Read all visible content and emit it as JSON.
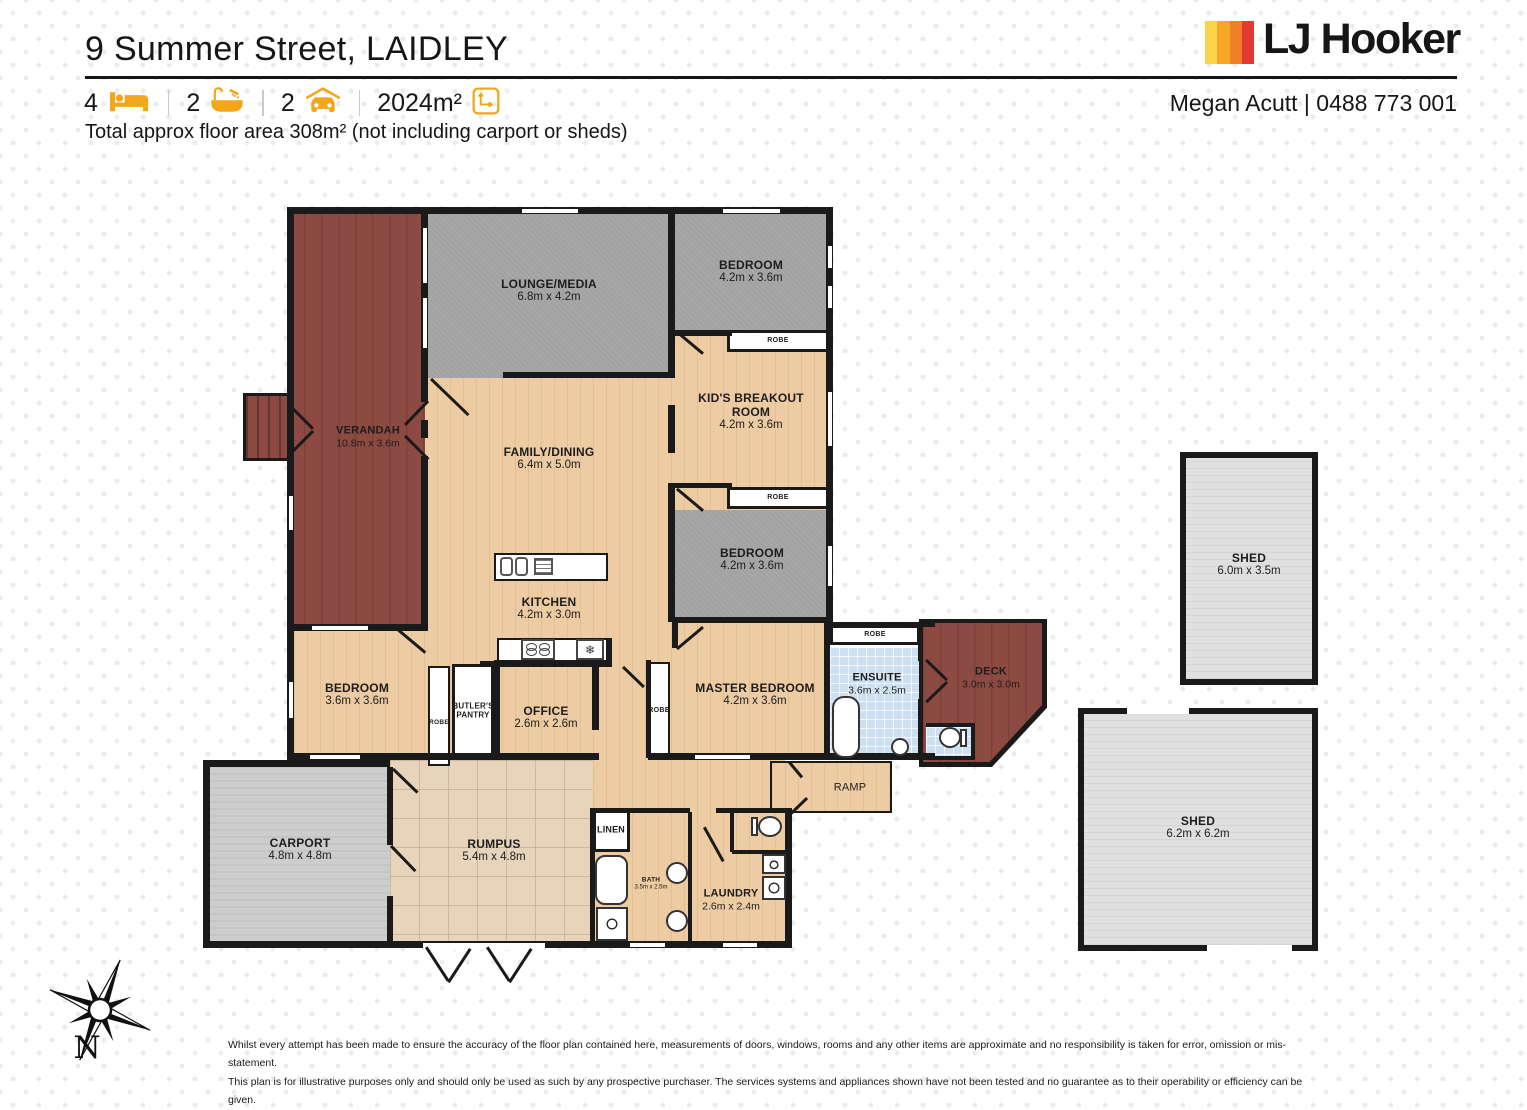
{
  "header": {
    "title": "9 Summer Street, LAIDLEY",
    "stats": {
      "beds": "4",
      "baths": "2",
      "cars": "2",
      "land_area": "2024m²"
    },
    "floor_area_note": "Total approx floor area 308m² (not including carport or sheds)",
    "brand": "LJ Hooker",
    "agent": "Megan Acutt | 0488 773 001"
  },
  "plan": {
    "robe_label": "ROBE",
    "compass_label": "N",
    "rooms": {
      "verandah": {
        "name": "VERANDAH",
        "dims": "10.8m x 3.6m"
      },
      "lounge": {
        "name": "LOUNGE/MEDIA",
        "dims": "6.8m x 4.2m"
      },
      "bedroom_top": {
        "name": "BEDROOM",
        "dims": "4.2m x 3.6m"
      },
      "kids": {
        "name": "KID'S BREAKOUT ROOM",
        "dims": "4.2m x 3.6m"
      },
      "bedroom_mid": {
        "name": "BEDROOM",
        "dims": "4.2m x 3.6m"
      },
      "family": {
        "name": "FAMILY/DINING",
        "dims": "6.4m x 5.0m"
      },
      "kitchen": {
        "name": "KITCHEN",
        "dims": "4.2m x 3.0m"
      },
      "bedroom_left": {
        "name": "BEDROOM",
        "dims": "3.6m x 3.6m"
      },
      "butlers": {
        "name": "BUTLER'S PANTRY"
      },
      "office": {
        "name": "OFFICE",
        "dims": "2.6m x 2.6m"
      },
      "master": {
        "name": "MASTER BEDROOM",
        "dims": "4.2m x 3.6m"
      },
      "ensuite": {
        "name": "ENSUITE",
        "dims": "3.6m x 2.5m"
      },
      "deck": {
        "name": "DECK",
        "dims": "3.0m x 3.0m"
      },
      "shed_top": {
        "name": "SHED",
        "dims": "6.0m x 3.5m"
      },
      "carport": {
        "name": "CARPORT",
        "dims": "4.8m x 4.8m"
      },
      "rumpus": {
        "name": "RUMPUS",
        "dims": "5.4m x 4.8m"
      },
      "linen": {
        "name": "LINEN"
      },
      "bath": {
        "name": "BATH",
        "dims": "3.5m x 2.5m"
      },
      "laundry": {
        "name": "LAUNDRY",
        "dims": "2.6m x 2.4m"
      },
      "ramp": {
        "name": "RAMP"
      },
      "shed_bottom": {
        "name": "SHED",
        "dims": "6.2m x 6.2m"
      }
    }
  },
  "icons": {
    "snowflake": "❄"
  },
  "colors": {
    "accent_gold": "#F2A71B",
    "verandah_red": "#8C4A42",
    "carpet_grey": "#A2A2A2",
    "timber": "#EDCBA3",
    "tile_beige": "#E8D3BB",
    "wet_area_blue": "#CDE0F2",
    "carport_grey": "#CDCDCD",
    "shed_grey": "#E0E0E0",
    "wall_black": "#1A1A1A",
    "logo_yellow": "#FBD44C",
    "logo_gold": "#F6A825",
    "logo_orange": "#EE7E27",
    "logo_red": "#E23B31"
  },
  "footer": {
    "disclaimer_line1": "Whilst every attempt has been made to ensure the accuracy of the floor plan contained here, measurements of doors, windows, rooms and any other items are approximate and no responsibility is taken for error, omission or mis-statement.",
    "disclaimer_line2": "This plan is for illustrative purposes only and should only be used as such by any prospective purchaser. The services systems and appliances shown have not been tested and no guarantee as to their operability or efficiency can be given."
  }
}
